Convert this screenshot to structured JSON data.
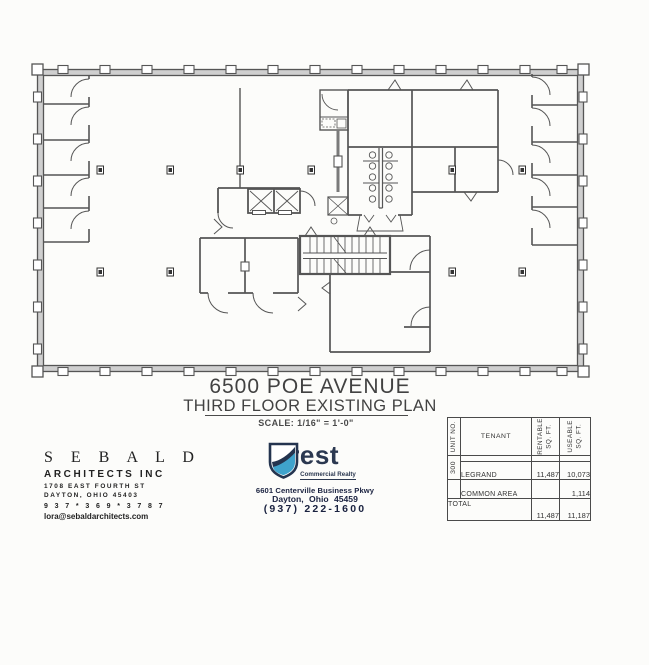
{
  "title": {
    "line1": "6500 POE AVENUE",
    "line2": "THIRD FLOOR EXISTING PLAN",
    "scale": "SCALE:  1/16\" = 1'-0\""
  },
  "architect": {
    "name": "S E B A L D",
    "firm": "ARCHITECTS INC",
    "address1": "1708 EAST FOURTH ST",
    "address2": "DAYTON, OHIO   45403",
    "phone": "9 3 7 * 3 6 9 * 3 7 8 7",
    "email": "lora@sebaldarchitects.com"
  },
  "realtor": {
    "brand": "Crest",
    "tagline": "Commercial Realty",
    "address1": "6601 Centerville Business Pkwy",
    "address2": "Dayton, Ohio  45459",
    "phone": "(937) 222-1600"
  },
  "schedule": {
    "headers": {
      "unit": "UNIT NO.",
      "tenant": "TENANT",
      "rentable": "RENTABLE\nSQ. FT.",
      "useable": "USEABLE\nSQ. FT."
    },
    "rows": [
      {
        "unit": "300",
        "tenant": "LEGRAND",
        "rentable": "11,487",
        "useable": "10,073"
      },
      {
        "unit": "",
        "tenant": "COMMON AREA",
        "rentable": "",
        "useable": "1,114"
      }
    ],
    "total_label": "TOTAL",
    "total_rentable": "11,487",
    "total_useable": "11,187"
  },
  "colors": {
    "navy": "#24344f",
    "light_blue": "#3fa3cc",
    "wall": "#555555"
  }
}
